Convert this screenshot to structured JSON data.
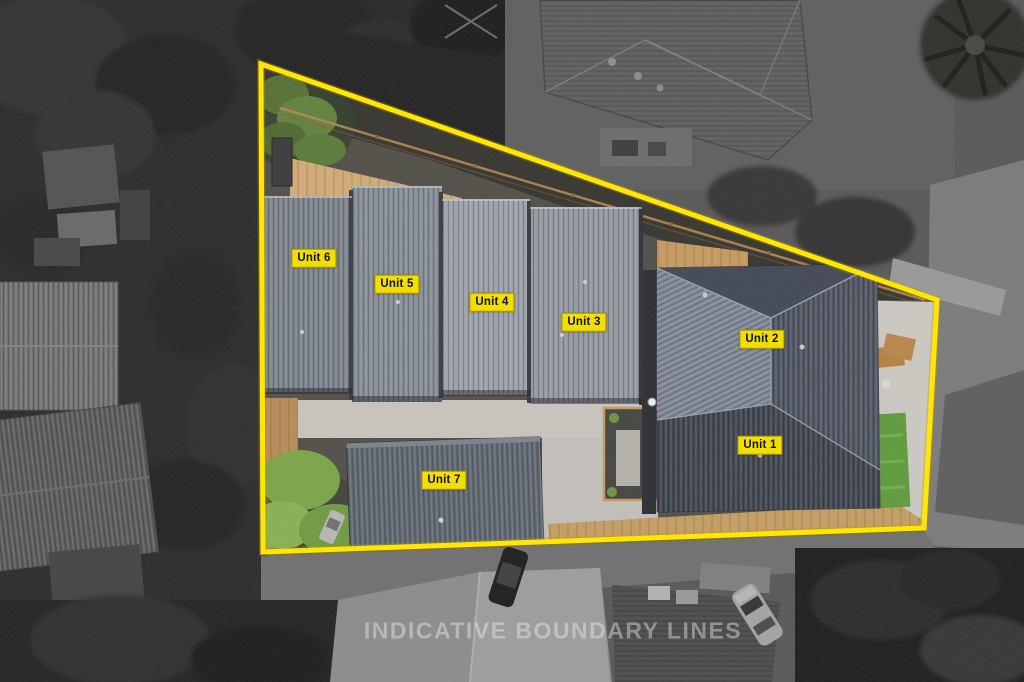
{
  "scene": {
    "kind": "aerial-drone-photo",
    "treatment": "property in colour, surroundings desaturated"
  },
  "boundary": {
    "points_str": "261,64 937,300 924,528 263,552"
  },
  "units": [
    {
      "label": "Unit 1",
      "x": 760,
      "y": 445
    },
    {
      "label": "Unit 2",
      "x": 762,
      "y": 339
    },
    {
      "label": "Unit 3",
      "x": 584,
      "y": 322
    },
    {
      "label": "Unit 4",
      "x": 492,
      "y": 302
    },
    {
      "label": "Unit 5",
      "x": 397,
      "y": 284
    },
    {
      "label": "Unit 6",
      "x": 314,
      "y": 258
    },
    {
      "label": "Unit 7",
      "x": 444,
      "y": 480
    }
  ],
  "watermark": {
    "text": "INDICATIVE BOUNDARY LINES"
  },
  "colors": {
    "boundary": "#FFE606",
    "label_bg": "#F2DE04",
    "label_text": "#111111",
    "watermark": "rgba(240,240,240,0.42)"
  }
}
